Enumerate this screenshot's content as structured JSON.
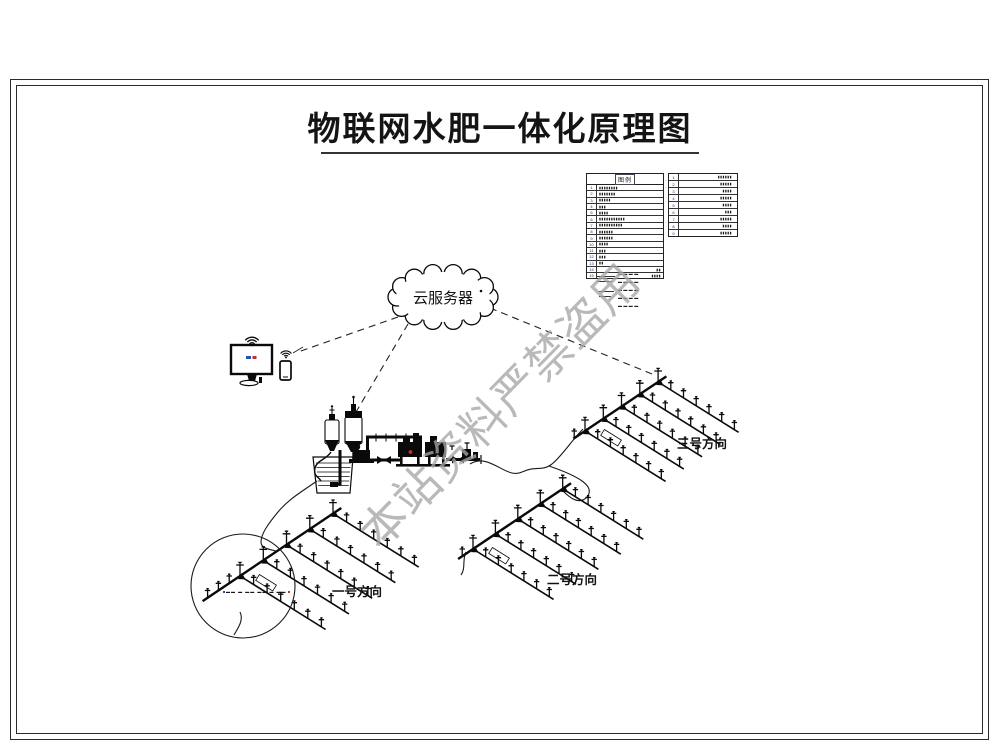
{
  "title": "物联网水肥一体化原理图",
  "watermark": "本站资料严禁盗用",
  "cloud": {
    "label": "云服务器"
  },
  "fields": [
    {
      "label": "一号方向"
    },
    {
      "label": "二号方向"
    },
    {
      "label": "三号方向"
    }
  ],
  "legend": {
    "header": "图例",
    "left_rows": [
      {
        "no": "1",
        "desc": "▮▮▮▮▮▮▮▮"
      },
      {
        "no": "2",
        "desc": "▮▮▮▮▮▮▮"
      },
      {
        "no": "3",
        "desc": "▮▮▮▮▮"
      },
      {
        "no": "4",
        "desc": "▮▮▮"
      },
      {
        "no": "5",
        "desc": "▮▮▮▮"
      },
      {
        "no": "6",
        "desc": "▮▮▮▮▮▮▮▮▮▮▮"
      },
      {
        "no": "7",
        "desc": "▮▮▮▮▮▮▮▮▮▮"
      },
      {
        "no": "8",
        "desc": "▮▮▮▮▮▮"
      },
      {
        "no": "9",
        "desc": "▮▮▮▮▮▮"
      },
      {
        "no": "10",
        "desc": "▮▮▮▮"
      },
      {
        "no": "11",
        "desc": "▮▮▮"
      },
      {
        "no": "12",
        "desc": "▮▮▮"
      },
      {
        "no": "13",
        "desc": "▮▮"
      },
      {
        "no": "14",
        "desc": "▮▮",
        "right": true
      },
      {
        "no": "15",
        "desc": "▮▮▮▮",
        "right": true
      }
    ],
    "right_rows": [
      {
        "no": "1",
        "desc": "▮▮▮▮▮▮"
      },
      {
        "no": "2",
        "desc": "▮▮▮▮▮"
      },
      {
        "no": "3",
        "desc": "▮▮▮▮"
      },
      {
        "no": "4",
        "desc": "▮▮▮▮▮"
      },
      {
        "no": "5",
        "desc": "▮▮▮▮"
      },
      {
        "no": "6",
        "desc": "▮▮▮"
      },
      {
        "no": "7",
        "desc": "▮▮▮▮▮"
      },
      {
        "no": "8",
        "desc": "▮▮▮▮"
      },
      {
        "no": "9",
        "desc": "▮▮▮▮▮"
      }
    ],
    "notes": [
      "▬▬▬▬",
      "▬▬▬▬",
      "▬▬▬▬",
      "▬▬▬▬",
      "▬▬▬▬"
    ]
  },
  "detail_note": "▬▬ ▬ ▬▬ ▬▬ ▬ ▬▬",
  "colors": {
    "ink": "#0a0a0a",
    "watermark": "#a6a6a6",
    "alert_dot": "#d03020",
    "screen_blue": "#2b50b8",
    "screen_red": "#c03426"
  }
}
